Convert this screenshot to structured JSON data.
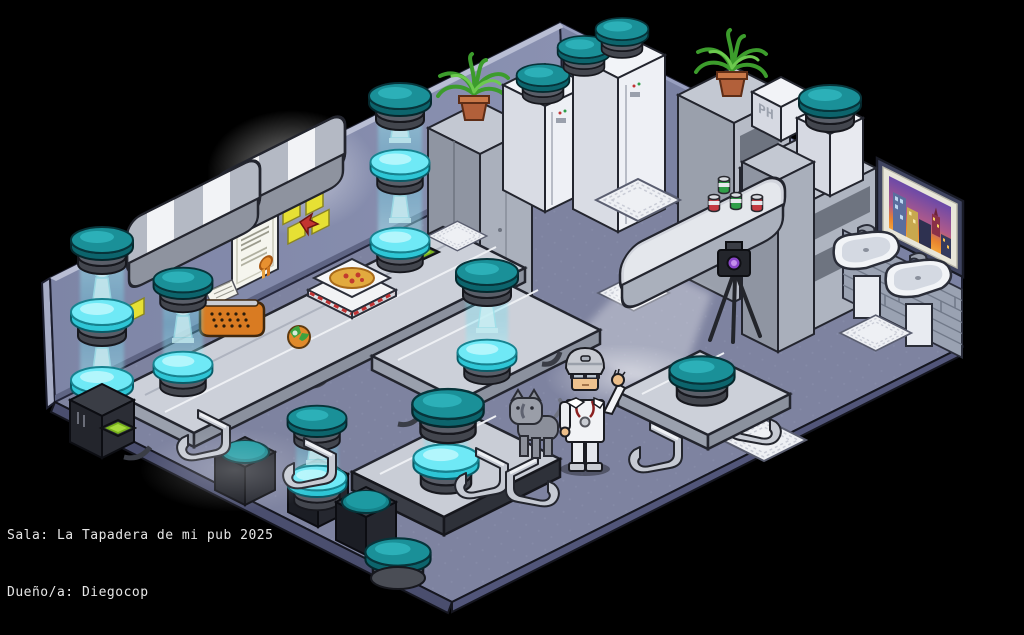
{
  "window": {
    "width": 1024,
    "height": 635,
    "background": "#000000"
  },
  "status_bar": {
    "room_line": "Sala: La Tapadera de mi pub 2025",
    "owner_line": "Dueño/a: Diegocop",
    "text_color": "#e6e6e6"
  },
  "labels": {
    "ph_box": "PH"
  },
  "palette": {
    "wall_left": "#858cad",
    "wall_right": "#7b82a3",
    "floor": "#7e83a0",
    "floor_edge": "#4a4e6e",
    "stool_teal": "#1a9098",
    "holo_cyan": "#6fe9f6",
    "furniture_light": "#ced2da",
    "furniture_dark": "#23252e",
    "accent_orange": "#d97b22",
    "note_yellow": "#e6e034",
    "screen_green": "#79b31d",
    "can_red": "#c43a42",
    "can_green": "#2f9e48",
    "plant_green": "#3c9c2c",
    "pot_terracotta": "#b2603a"
  },
  "furniture_inventory": [
    {
      "name": "teal-bar-stool",
      "count": 13
    },
    {
      "name": "holo-glow-stool",
      "count": 8
    },
    {
      "name": "holo-pillar-beam",
      "count": 6
    },
    {
      "name": "padded-bench",
      "count": 2
    },
    {
      "name": "lab-table",
      "count": 3
    },
    {
      "name": "low-platform-table",
      "count": 1
    },
    {
      "name": "chrome-cantilever-chair",
      "count": 6
    },
    {
      "name": "black-cube-seat",
      "count": 3
    },
    {
      "name": "refrigerator",
      "count": 2
    },
    {
      "name": "locker-cabinet",
      "count": 1
    },
    {
      "name": "shelf-unit",
      "count": 2
    },
    {
      "name": "bar-counter",
      "count": 1
    },
    {
      "name": "soda-can",
      "count": 4
    },
    {
      "name": "potted-plant",
      "count": 2
    },
    {
      "name": "ph-crate",
      "count": 1
    },
    {
      "name": "stool-pedestal",
      "count": 1
    },
    {
      "name": "city-skyline-painting",
      "count": 1
    },
    {
      "name": "brick-wall-section",
      "count": 1
    },
    {
      "name": "bathroom-sink",
      "count": 2
    },
    {
      "name": "waffle-floor-mat",
      "count": 4
    },
    {
      "name": "cash-register",
      "count": 1
    },
    {
      "name": "green-screen-panel",
      "count": 2
    },
    {
      "name": "typewriter",
      "count": 1
    },
    {
      "name": "pizza-box-stack",
      "count": 1
    },
    {
      "name": "toy-ball",
      "count": 1
    },
    {
      "name": "camera-tripod",
      "count": 1
    },
    {
      "name": "wall-certificate",
      "count": 1
    },
    {
      "name": "sticky-note",
      "count": 6
    },
    {
      "name": "heart-sticker",
      "count": 1
    },
    {
      "name": "keyboard-mat",
      "count": 1
    }
  ],
  "characters": [
    {
      "name": "scientist-avatar",
      "pose": "waving",
      "outfit": "white-lab-coat"
    },
    {
      "name": "gray-cat",
      "color": "#8b8f9a"
    }
  ]
}
